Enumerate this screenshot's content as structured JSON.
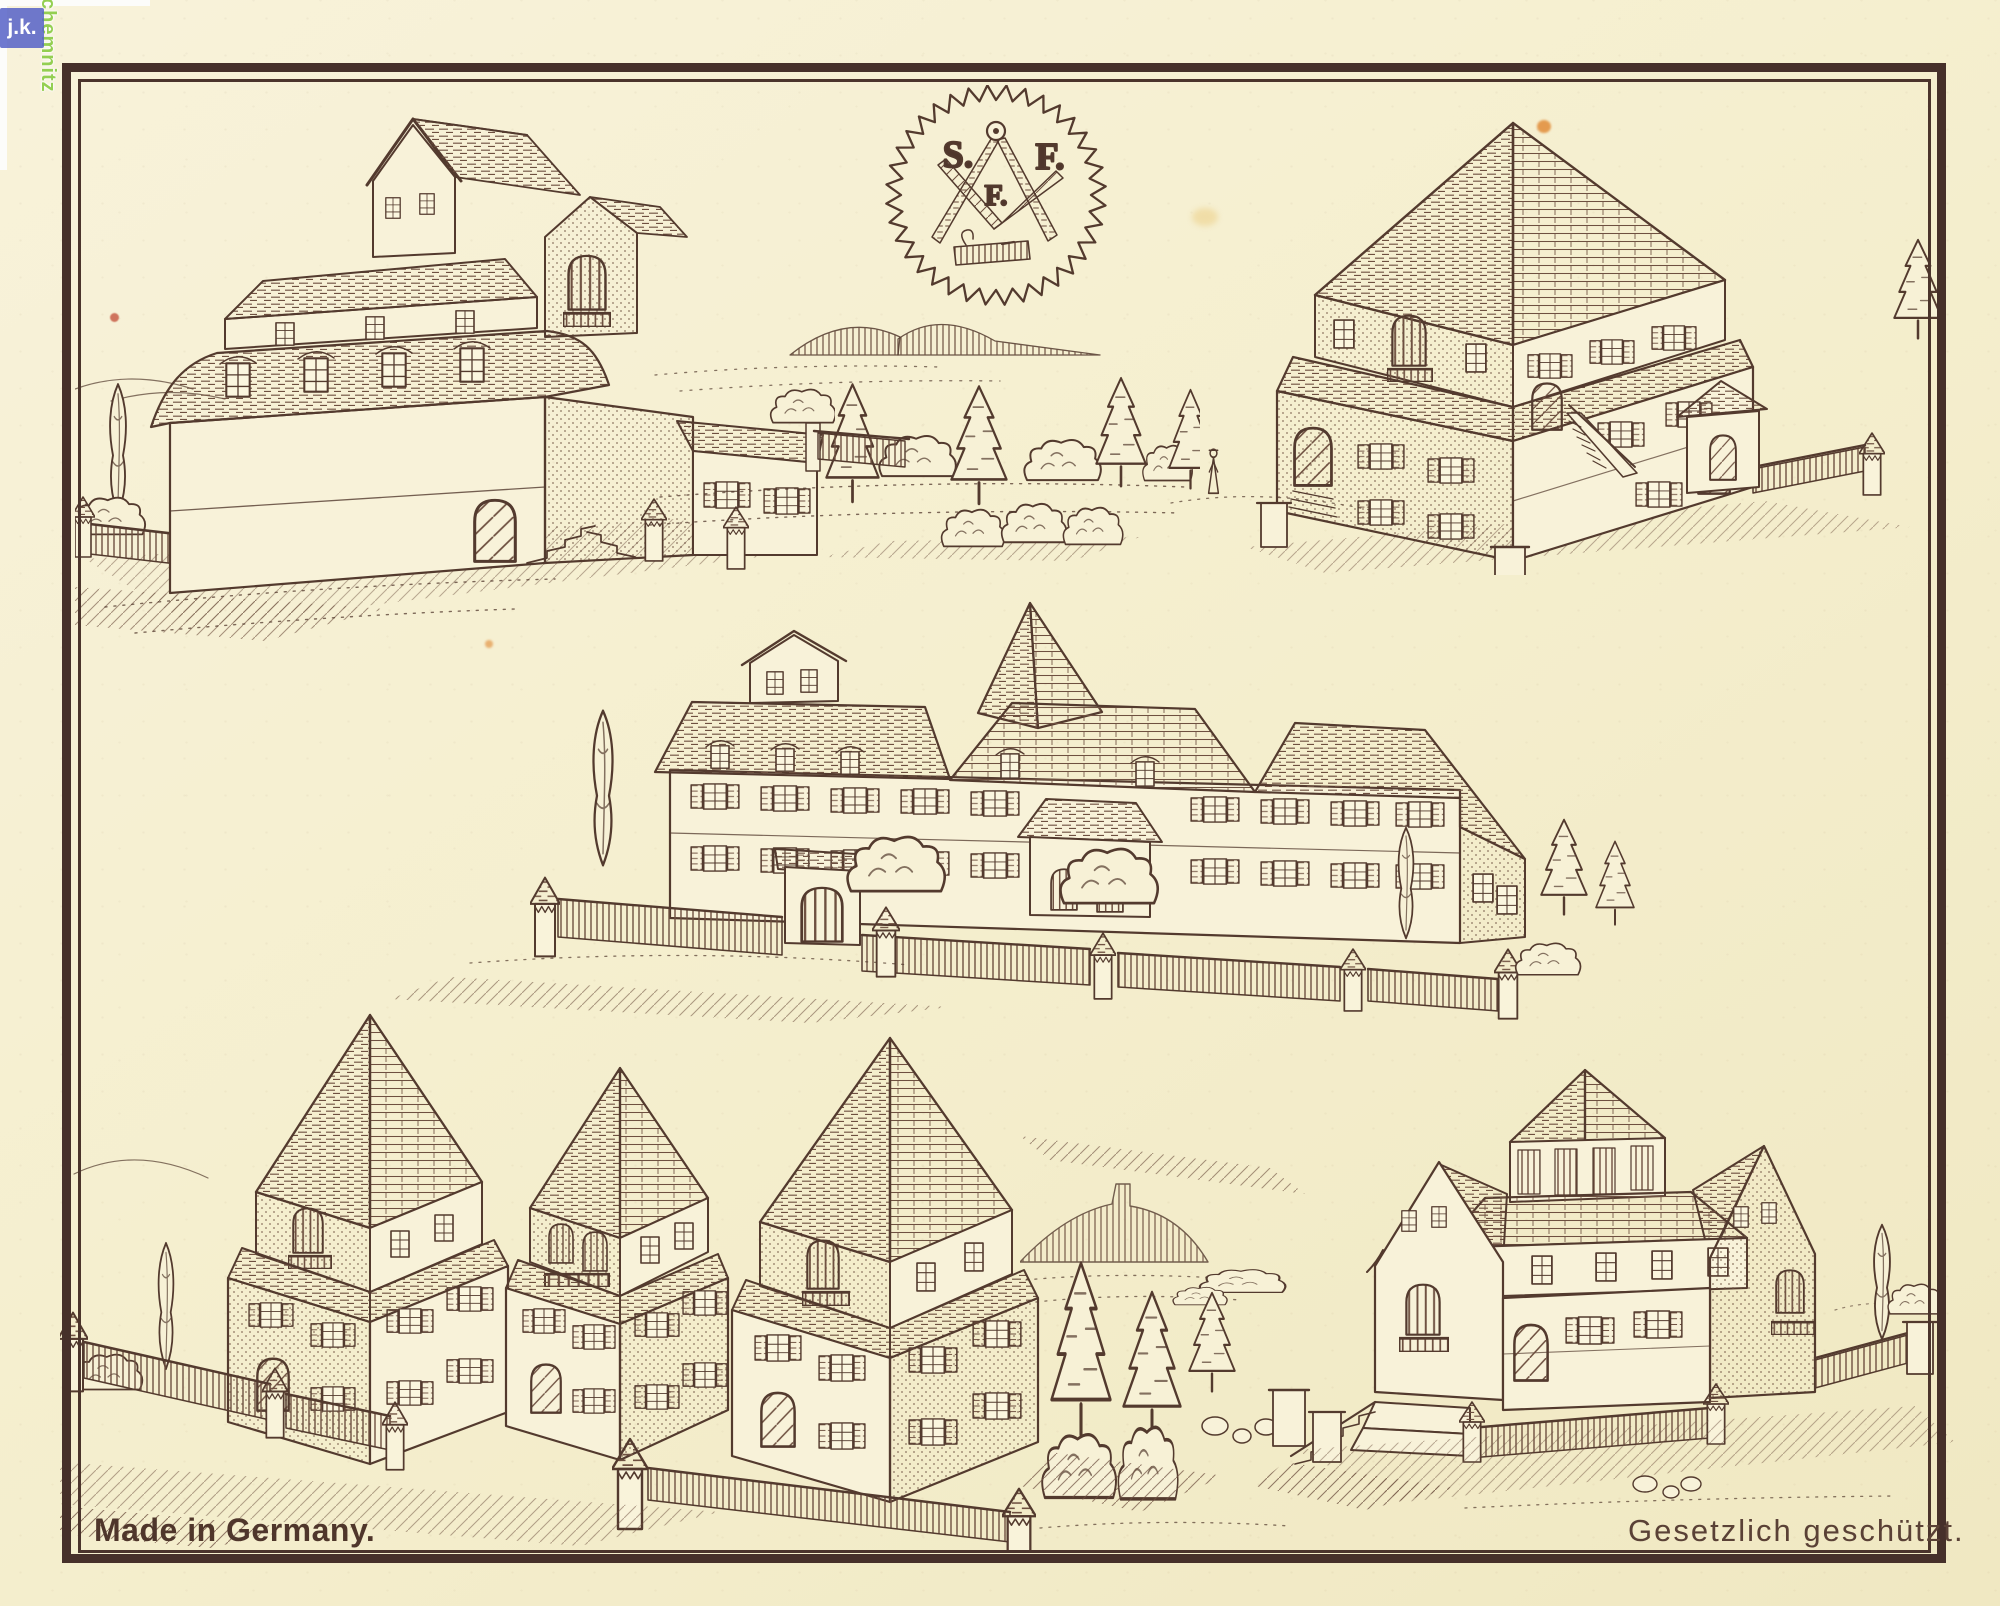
{
  "page": {
    "kind": "scanned vintage catalog plate",
    "subject": "building-block model houses"
  },
  "captions": {
    "made_in": "Made in Germany.",
    "protected": "Gesetzlich geschützt."
  },
  "trademark": {
    "letter_left": "S.",
    "letter_right": "F.",
    "letter_center": "F."
  },
  "watermark": {
    "initials": "j.k.",
    "city": "chemnitz"
  },
  "palette": {
    "paper": "#f5efcf",
    "ink": "#533a2e",
    "frame": "#46302a",
    "watermark_blue": "#5661c7",
    "watermark_green": "#94cf52",
    "stain_orange": "#e0862f",
    "stain_red": "#c24b35"
  },
  "illustrations": [
    {
      "name": "mansard-villa-with-garden-fence"
    },
    {
      "name": "sf-saw-blade-trademark"
    },
    {
      "name": "pyramid-roof-house-with-gatehouse"
    },
    {
      "name": "walled-manor-with-central-spire"
    },
    {
      "name": "row-of-three-tower-houses"
    },
    {
      "name": "lantern-tower-villa-with-terrace"
    }
  ]
}
